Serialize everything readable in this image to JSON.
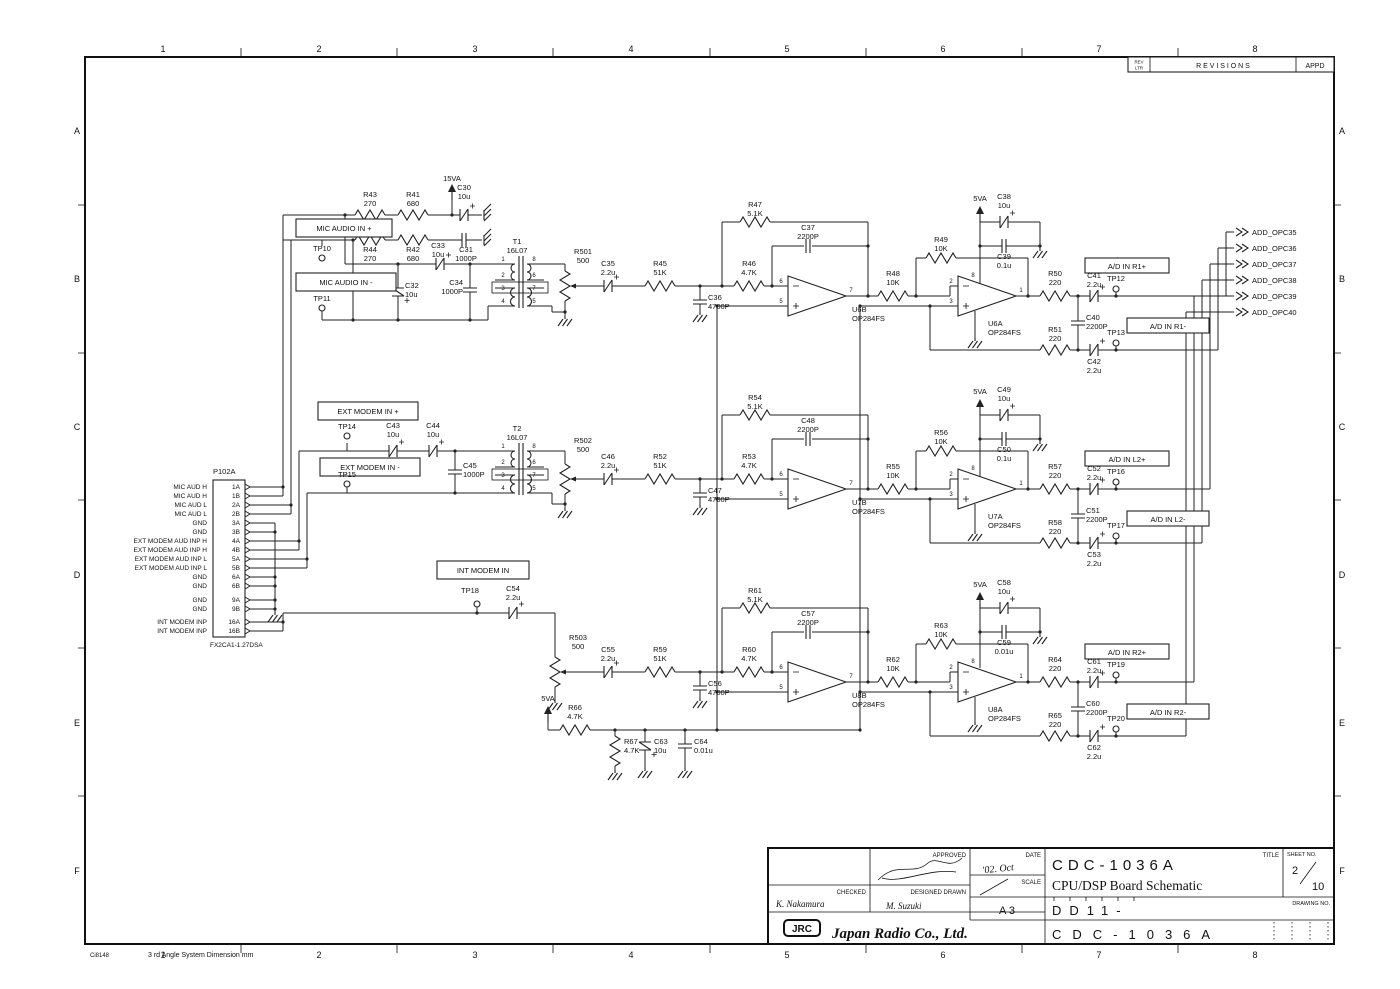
{
  "grid": {
    "cols": [
      "1",
      "2",
      "3",
      "4",
      "5",
      "6",
      "7",
      "8"
    ],
    "rows": [
      "A",
      "B",
      "C",
      "D",
      "E",
      "F"
    ]
  },
  "rev": {
    "ltr1": "REV",
    "ltr2": "LTR",
    "title": "R E V I S I O N S",
    "appd": "APPD"
  },
  "footer": {
    "code": "Ci8148",
    "note": "3 rd Angle System  Dimension mm"
  },
  "pwr": {
    "v15": "15VA",
    "v5": "5VA"
  },
  "io": {
    "mic_p": "MIC AUDIO IN +",
    "mic_m": "MIC AUDIO IN -",
    "ext_p": "EXT MODEM IN +",
    "ext_m": "EXT MODEM IN -",
    "int_in": "INT MODEM IN"
  },
  "ad": {
    "r1p": "A/D IN R1+",
    "r1m": "A/D IN R1-",
    "l2p": "A/D IN L2+",
    "l2m": "A/D IN L2-",
    "r2p": "A/D IN R2+",
    "r2m": "A/D IN R2-"
  },
  "out": [
    "ADD_OPC35",
    "ADD_OPC36",
    "ADD_OPC37",
    "ADD_OPC38",
    "ADD_OPC39",
    "ADD_OPC40"
  ],
  "tp": {
    "TP10": "TP10",
    "TP11": "TP11",
    "TP12": "TP12",
    "TP13": "TP13",
    "TP14": "TP14",
    "TP15": "TP15",
    "TP16": "TP16",
    "TP17": "TP17",
    "TP18": "TP18",
    "TP19": "TP19",
    "TP20": "TP20"
  },
  "pins": {
    "xf": [
      "1",
      "2",
      "3",
      "4",
      "8",
      "6",
      "7",
      "5"
    ],
    "oa": [
      "6",
      "5",
      "7",
      "2",
      "3",
      "1",
      "8"
    ]
  },
  "connector": {
    "name": "P102A",
    "part": "FX2CA1-1.27DSA",
    "pins": [
      {
        "l": "MIC AUD H",
        "n": "1A"
      },
      {
        "l": "MIC AUD H",
        "n": "1B"
      },
      {
        "l": "MIC AUD L",
        "n": "2A"
      },
      {
        "l": "MIC AUD L",
        "n": "2B"
      },
      {
        "l": "GND",
        "n": "3A"
      },
      {
        "l": "GND",
        "n": "3B"
      },
      {
        "l": "EXT MODEM AUD INP H",
        "n": "4A"
      },
      {
        "l": "EXT MODEM AUD INP H",
        "n": "4B"
      },
      {
        "l": "EXT MODEM AUD INP L",
        "n": "5A"
      },
      {
        "l": "EXT MODEM AUD INP L",
        "n": "5B"
      },
      {
        "l": "GND",
        "n": "6A"
      },
      {
        "l": "GND",
        "n": "6B"
      },
      {
        "l": "GND",
        "n": "9A"
      },
      {
        "l": "GND",
        "n": "9B"
      },
      {
        "l": "INT MODEM INP",
        "n": "16A"
      },
      {
        "l": "INT MODEM INP",
        "n": "16B"
      }
    ]
  },
  "p": {
    "R43": [
      "R43",
      "270"
    ],
    "R41": [
      "R41",
      "680"
    ],
    "R44": [
      "R44",
      "270"
    ],
    "R42": [
      "R42",
      "680"
    ],
    "C30": [
      "C30",
      "10u"
    ],
    "C31": [
      "C31",
      "1000P"
    ],
    "C32": [
      "C32",
      "10u"
    ],
    "C33": [
      "C33",
      "10u"
    ],
    "C34": [
      "C34",
      "1000P"
    ],
    "T1": [
      "T1",
      "16L07"
    ],
    "R501": [
      "R501",
      "500"
    ],
    "C35": [
      "C35",
      "2.2u"
    ],
    "R45": [
      "R45",
      "51K"
    ],
    "C36": [
      "C36",
      "4700P"
    ],
    "R46": [
      "R46",
      "4.7K"
    ],
    "R47": [
      "R47",
      "5.1K"
    ],
    "C37": [
      "C37",
      "2200P"
    ],
    "U6B": [
      "U6B",
      "OP284FS"
    ],
    "R48": [
      "R48",
      "10K"
    ],
    "R49": [
      "R49",
      "10K"
    ],
    "C38": [
      "C38",
      "10u"
    ],
    "C39": [
      "C39",
      "0.1u"
    ],
    "U6A": [
      "U6A",
      "OP284FS"
    ],
    "R50": [
      "R50",
      "220"
    ],
    "R51": [
      "R51",
      "220"
    ],
    "C40": [
      "C40",
      "2200P"
    ],
    "C41": [
      "C41",
      "2.2u"
    ],
    "C42": [
      "C42",
      "2.2u"
    ],
    "C43": [
      "C43",
      "10u"
    ],
    "C44": [
      "C44",
      "10u"
    ],
    "C45": [
      "C45",
      "1000P"
    ],
    "T2": [
      "T2",
      "16L07"
    ],
    "R502": [
      "R502",
      "500"
    ],
    "C46": [
      "C46",
      "2.2u"
    ],
    "R52": [
      "R52",
      "51K"
    ],
    "C47": [
      "C47",
      "4700P"
    ],
    "R53": [
      "R53",
      "4.7K"
    ],
    "R54": [
      "R54",
      "5.1K"
    ],
    "C48": [
      "C48",
      "2200P"
    ],
    "U7B": [
      "U7B",
      "OP284FS"
    ],
    "R55": [
      "R55",
      "10K"
    ],
    "R56": [
      "R56",
      "10K"
    ],
    "C49": [
      "C49",
      "10u"
    ],
    "C50": [
      "C50",
      "0.1u"
    ],
    "U7A": [
      "U7A",
      "OP284FS"
    ],
    "R57": [
      "R57",
      "220"
    ],
    "R58": [
      "R58",
      "220"
    ],
    "C51": [
      "C51",
      "2200P"
    ],
    "C52": [
      "C52",
      "2.2u"
    ],
    "C53": [
      "C53",
      "2.2u"
    ],
    "C54": [
      "C54",
      "2.2u"
    ],
    "R503": [
      "R503",
      "500"
    ],
    "C55": [
      "C55",
      "2.2u"
    ],
    "R59": [
      "R59",
      "51K"
    ],
    "C56": [
      "C56",
      "4700P"
    ],
    "R60": [
      "R60",
      "4.7K"
    ],
    "R61": [
      "R61",
      "5.1K"
    ],
    "C57": [
      "C57",
      "2200P"
    ],
    "U8B": [
      "U8B",
      "OP284FS"
    ],
    "R62": [
      "R62",
      "10K"
    ],
    "R63": [
      "R63",
      "10K"
    ],
    "C58": [
      "C58",
      "10u"
    ],
    "C59": [
      "C59",
      "0.01u"
    ],
    "U8A": [
      "U8A",
      "OP284FS"
    ],
    "R64": [
      "R64",
      "220"
    ],
    "R65": [
      "R65",
      "220"
    ],
    "C60": [
      "C60",
      "2200P"
    ],
    "C61": [
      "C61",
      "2.2u"
    ],
    "C62": [
      "C62",
      "2.2u"
    ],
    "R66": [
      "R66",
      "4.7K"
    ],
    "R67": [
      "R67",
      "4.7K"
    ],
    "C63": [
      "C63",
      "10u"
    ],
    "C64": [
      "C64",
      "0.01u"
    ]
  },
  "tb": {
    "approved": "APPROVED",
    "checked": "CHECKED",
    "designed": "DESIGNED DRAWN",
    "date_l": "DATE",
    "date_v": "'02. Oct",
    "scale_l": "SCALE",
    "size": "A 3",
    "checked_sig": "K. Nakamura",
    "drawn_sig": "M. Suzuki",
    "logo": "JRC",
    "company": "Japan Radio Co., Ltd.",
    "model": "CDC-1036A",
    "title_l": "TITLE",
    "doc_title": "CPU/DSP Board Schematic",
    "sheet_l": "SHEET NO.",
    "sheet_no": "2",
    "sheet_total": "10",
    "drawing_l": "DRAWING NO.",
    "drawing_prefix": "DD11-",
    "drawing_no": "CDC-1036A"
  }
}
